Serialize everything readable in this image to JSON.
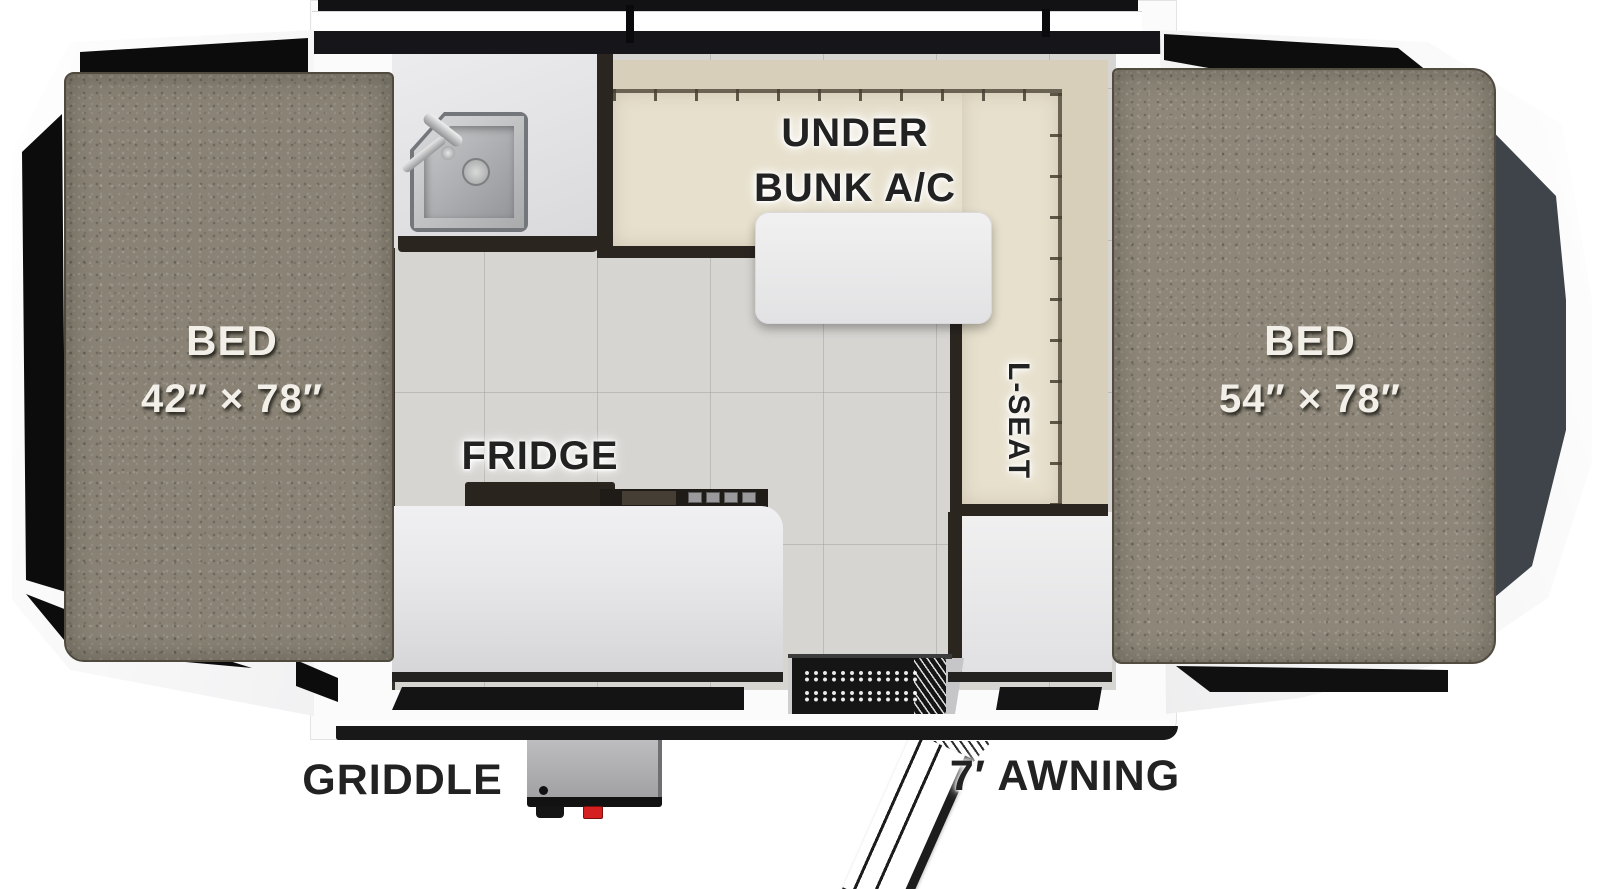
{
  "labels": {
    "bed_left_line1": "BED",
    "bed_left_line2": "42″ × 78″",
    "bed_right_line1": "BED",
    "bed_right_line2": "54″ × 78″",
    "under_bunk_line1": "UNDER",
    "under_bunk_line2": "BUNK A/C",
    "l_seat": "L-SEAT",
    "fridge": "FRIDGE",
    "griddle": "GRIDDLE",
    "awning": "7′ AWNING"
  },
  "fixtures": [
    "sink",
    "faucet",
    "dinette-table",
    "l-shaped-bench",
    "cooktop",
    "fridge-counter",
    "entry-step",
    "awning-arm",
    "griddle"
  ],
  "colors": {
    "body_white": "#fbfbfc",
    "trim_black": "#181818",
    "mattress": "#8e8779",
    "floor_tile": "#d7d5d2",
    "bench_seat": "#e7e0cd",
    "bench_back": "#d8cfba",
    "furniture_trim": "#2b2520",
    "counter": "#e7e7e9",
    "end_panel_gray": "#3f434a",
    "griddle_knob_red": "#d42020",
    "label_dark": "#222222",
    "label_light": "#f2efe9"
  }
}
